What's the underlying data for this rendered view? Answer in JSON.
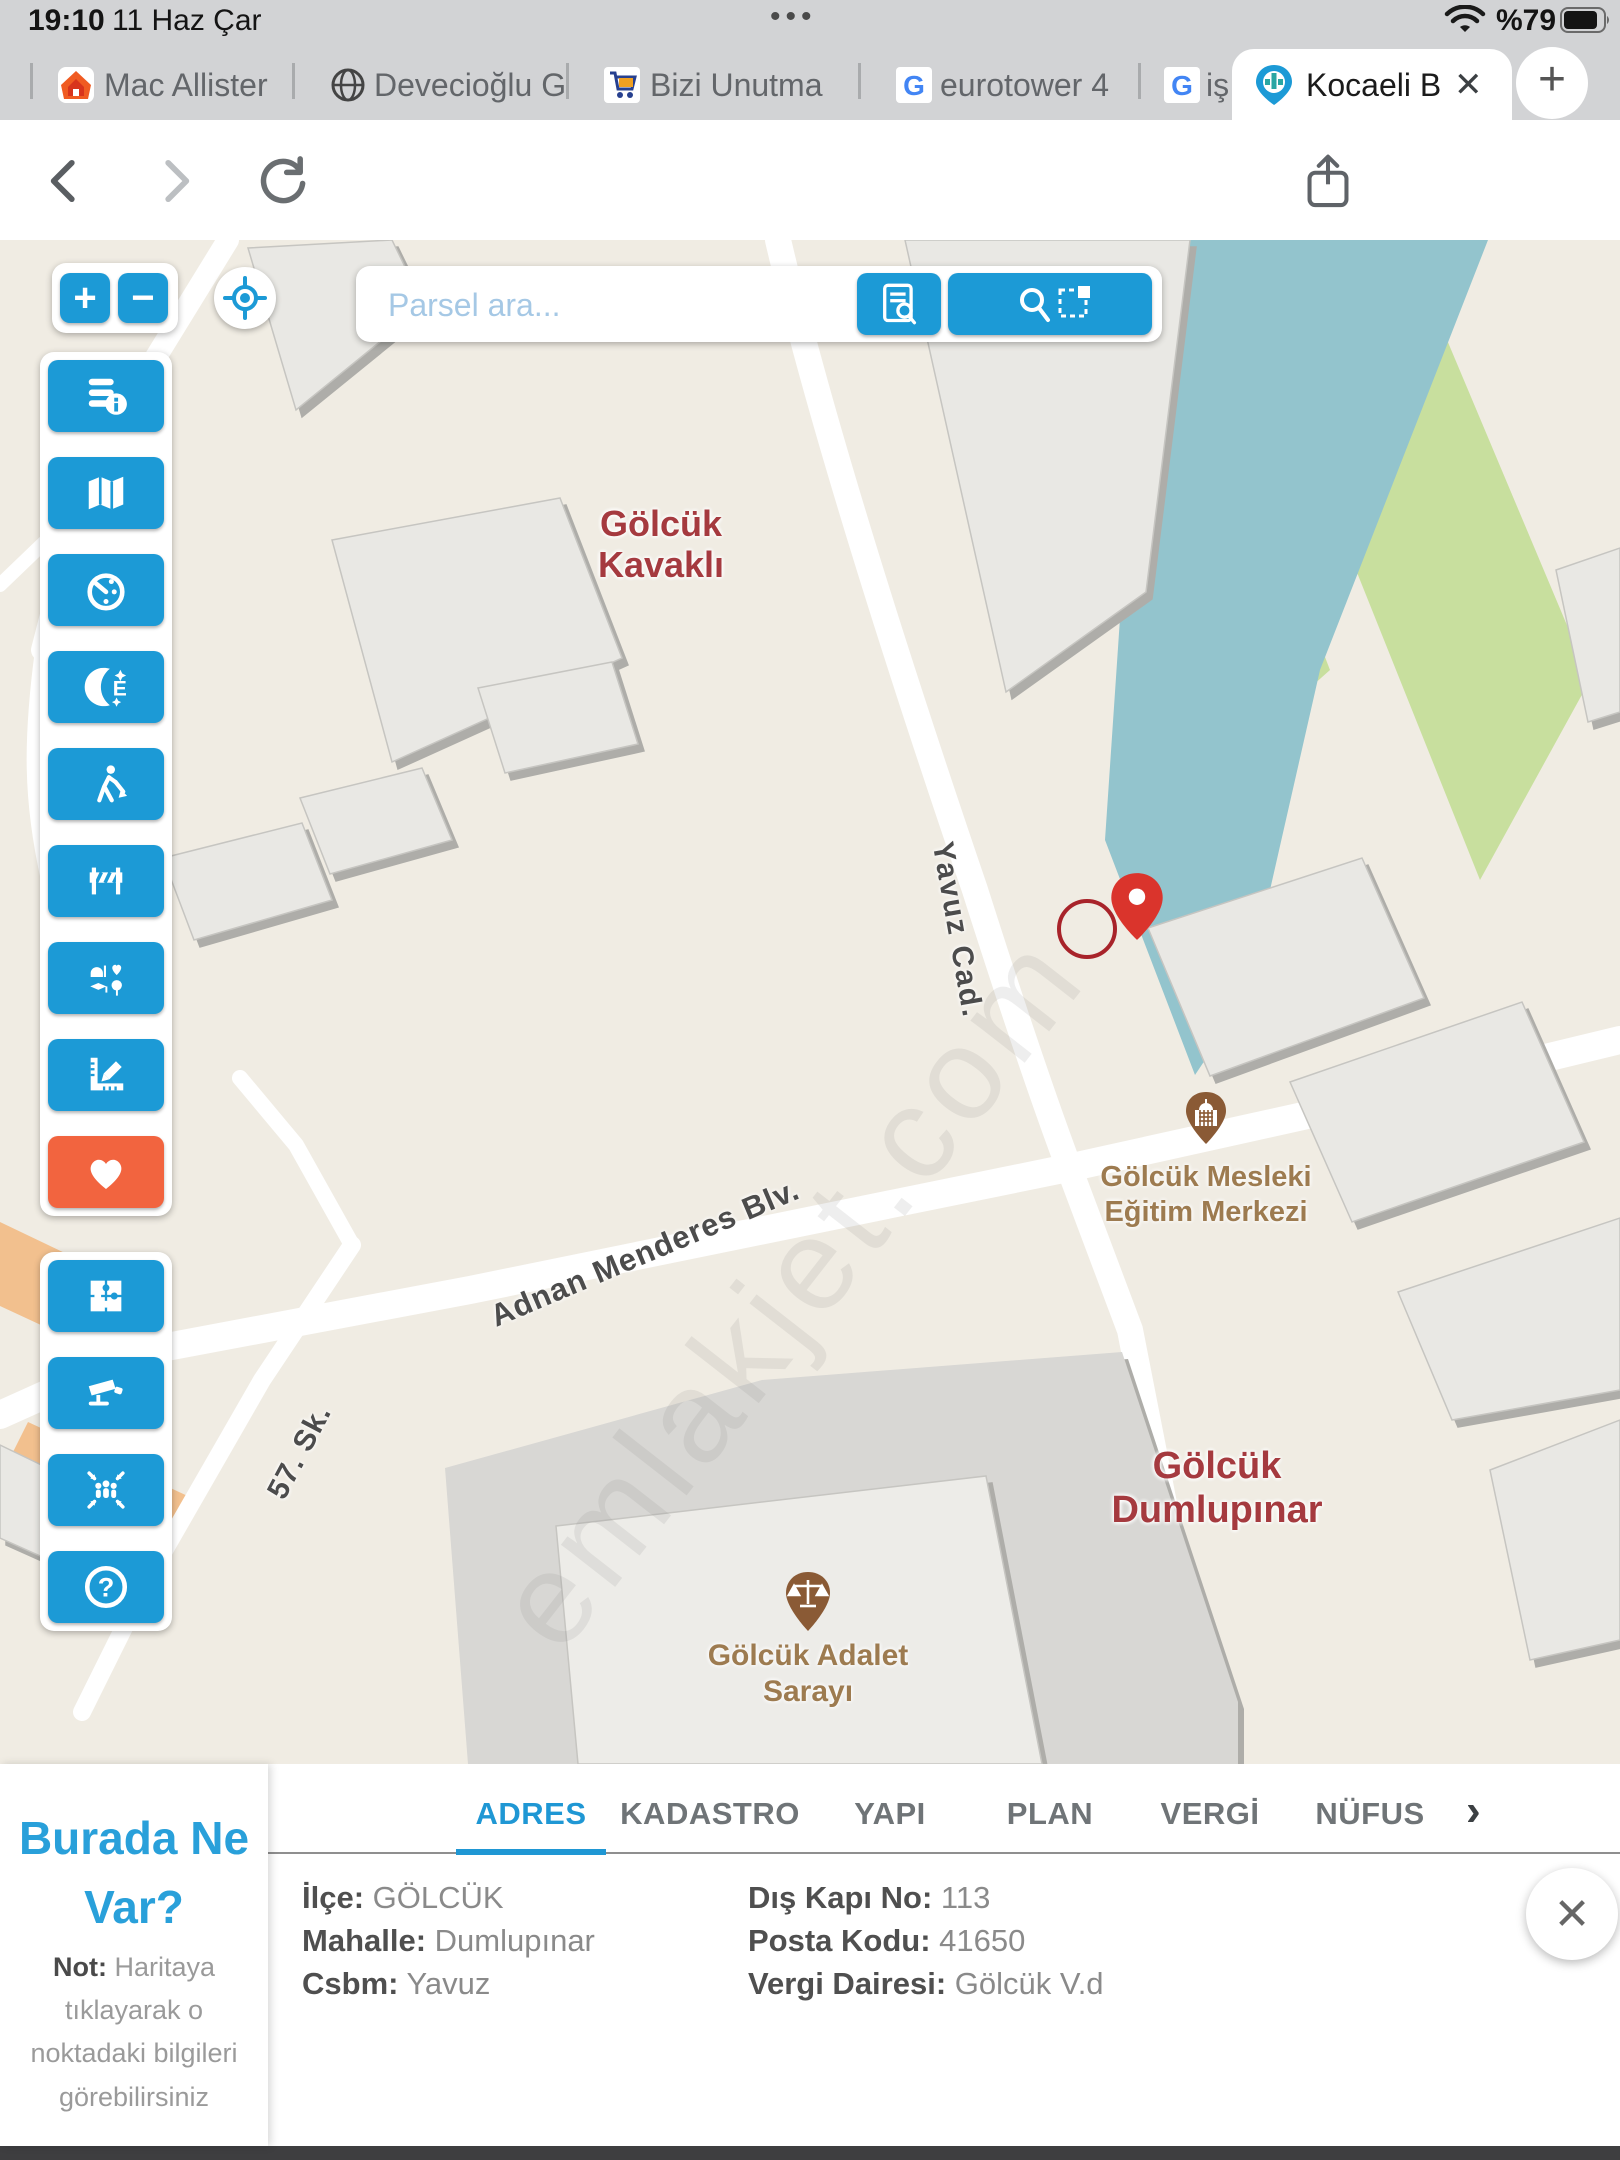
{
  "status_bar": {
    "time": "19:10",
    "date": "11 Haz Çar",
    "battery_percent": "%79",
    "menu_dots": "•••"
  },
  "tab_bar": {
    "tabs": [
      {
        "label": "Mac Allister",
        "icon": "home-icon"
      },
      {
        "label": "Devecioğlu G",
        "icon": "globe-icon"
      },
      {
        "label": "Bizi Unutma",
        "icon": "cart-icon"
      },
      {
        "label": "eurotower 4",
        "icon": "google-icon"
      },
      {
        "label": "iş",
        "icon": "google-icon"
      },
      {
        "label": "Kocaeli B",
        "icon": "kocaeli-pin-icon",
        "close": "✕"
      }
    ],
    "new_tab": "+"
  },
  "toolbar": {
    "url": "rehber.kocaeli.bel.tr",
    "tab_count": "6",
    "menu_dots": "•••"
  },
  "map": {
    "search": {
      "placeholder": "Parsel ara..."
    },
    "zoom_in": "+",
    "zoom_out": "−",
    "labels": {
      "area1_line1": "Gölcük",
      "area1_line2": "Kavaklı",
      "area2_line1": "Gölcük",
      "area2_line2": "Dumlupınar",
      "street_yavuz": "Yavuz Cad.",
      "street_adnan": "Adnan Menderes Blv.",
      "street_57": "57. Sk.",
      "poi1_line1": "Gölcük Mesleki",
      "poi1_line2": "Eğitim Merkezi",
      "poi2_line1": "Gölcük Adalet",
      "poi2_line2": "Sarayı",
      "watermark": "emlakjet.com"
    },
    "scale_label": "20 m",
    "disclaimer": "Veriler yalnızca bilgi amaçlıdır, resmi işlemlerde kullanılamaz. © 2025 Bilgi İşlem Dairesi Başkanlığı"
  },
  "sidebar": {
    "group1_icons": [
      "layers-info",
      "map",
      "duty-clock",
      "night-pharmacy",
      "roadworks",
      "barrier",
      "poi-categories",
      "measure",
      "favorites"
    ],
    "group2_icons": [
      "parcel-puzzle",
      "cctv",
      "assembly-point",
      "help"
    ],
    "glyphs": {
      "pharmacy_e": "E",
      "help": "?"
    }
  },
  "panel": {
    "title": "Burada Ne Var?",
    "note_label": "Not:",
    "note_text": " Haritaya tıklayarak o noktadaki bilgileri görebilirsiniz",
    "tabs": [
      "ADRES",
      "KADASTRO",
      "YAPI",
      "PLAN",
      "VERGİ",
      "NÜFUS"
    ],
    "active_tab": "ADRES",
    "more_tabs": "›",
    "close": "✕",
    "fields_col1": [
      {
        "label": "İlçe:",
        "value": " GÖLCÜK"
      },
      {
        "label": "Mahalle:",
        "value": " Dumlupınar"
      },
      {
        "label": "Csbm:",
        "value": " Yavuz"
      }
    ],
    "fields_col2": [
      {
        "label": "Dış Kapı No:",
        "value": " 113"
      },
      {
        "label": "Posta Kodu:",
        "value": " 41650"
      },
      {
        "label": "Vergi Dairesi:",
        "value": " Gölcük V.d"
      }
    ]
  },
  "colors": {
    "accent_blue": "#1c9ad6",
    "favorite_orange": "#f2643f",
    "map_red_label": "#a53a3f",
    "map_brown_label": "#9d7b50",
    "water": "#93c4cd",
    "green": "#c8df9e",
    "plaza": "#d8d7d4"
  }
}
